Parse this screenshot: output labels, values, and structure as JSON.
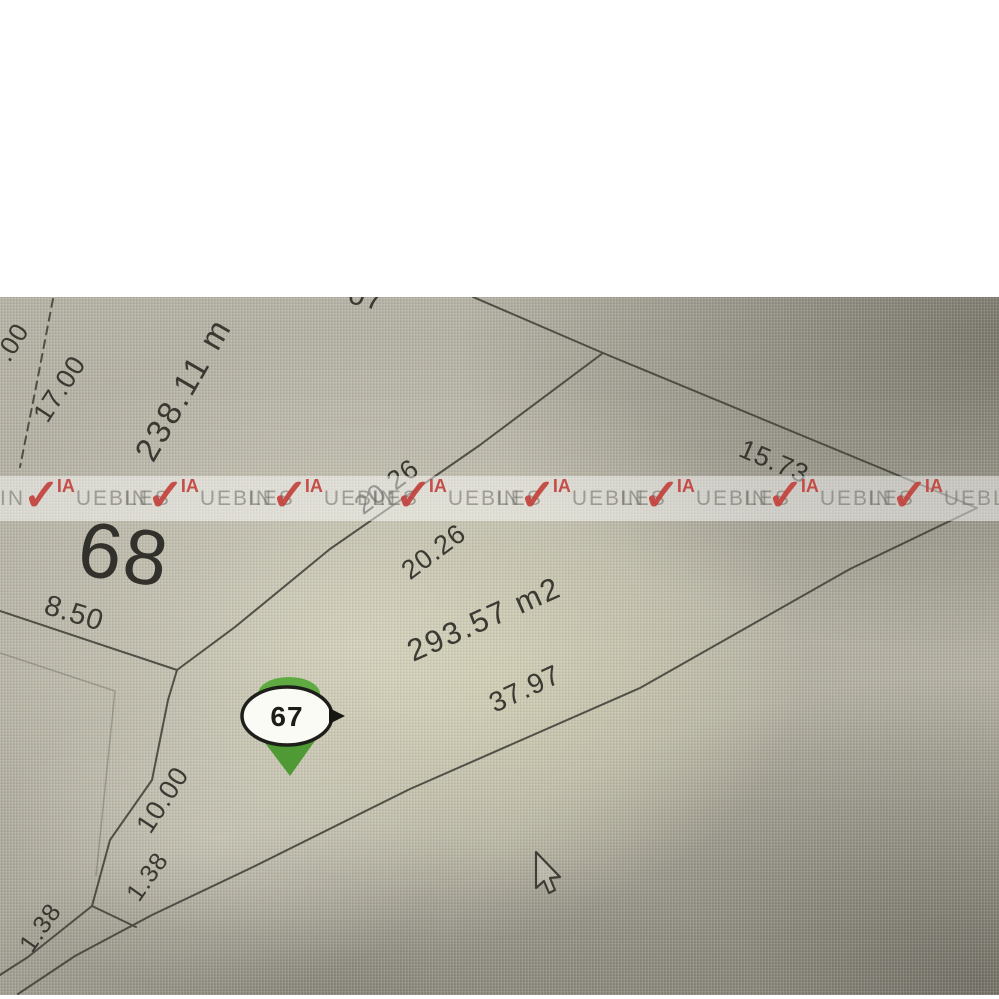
{
  "map": {
    "description_title": "Plat map photo",
    "watermark": {
      "brand": "VIA INMUEBLES",
      "in": "IN",
      "check": "✓",
      "ia": "IA",
      "uebles": "UEBLES",
      "accent_red": "#c2423c"
    },
    "pin": {
      "number": "67",
      "green": "#55a23a"
    },
    "lot68": {
      "number": "68",
      "area": "238.11 m",
      "edge_bottom": "8.50",
      "edge_left": "17.00"
    },
    "lot67": {
      "area": "293.57 m2",
      "edge_top_a": "20.26",
      "edge_top_b": "20.26",
      "edge_right": "15.73",
      "edge_bottom": "37.97",
      "edge_left_upper": "10.00",
      "edge_left_lower": "1.38",
      "edge_sliver": "1.38"
    },
    "partials": {
      "left_edge_dim": ".00",
      "top_edge_dim": "07"
    },
    "colors": {
      "line": "#45443c",
      "label": "#2f2e28"
    }
  }
}
